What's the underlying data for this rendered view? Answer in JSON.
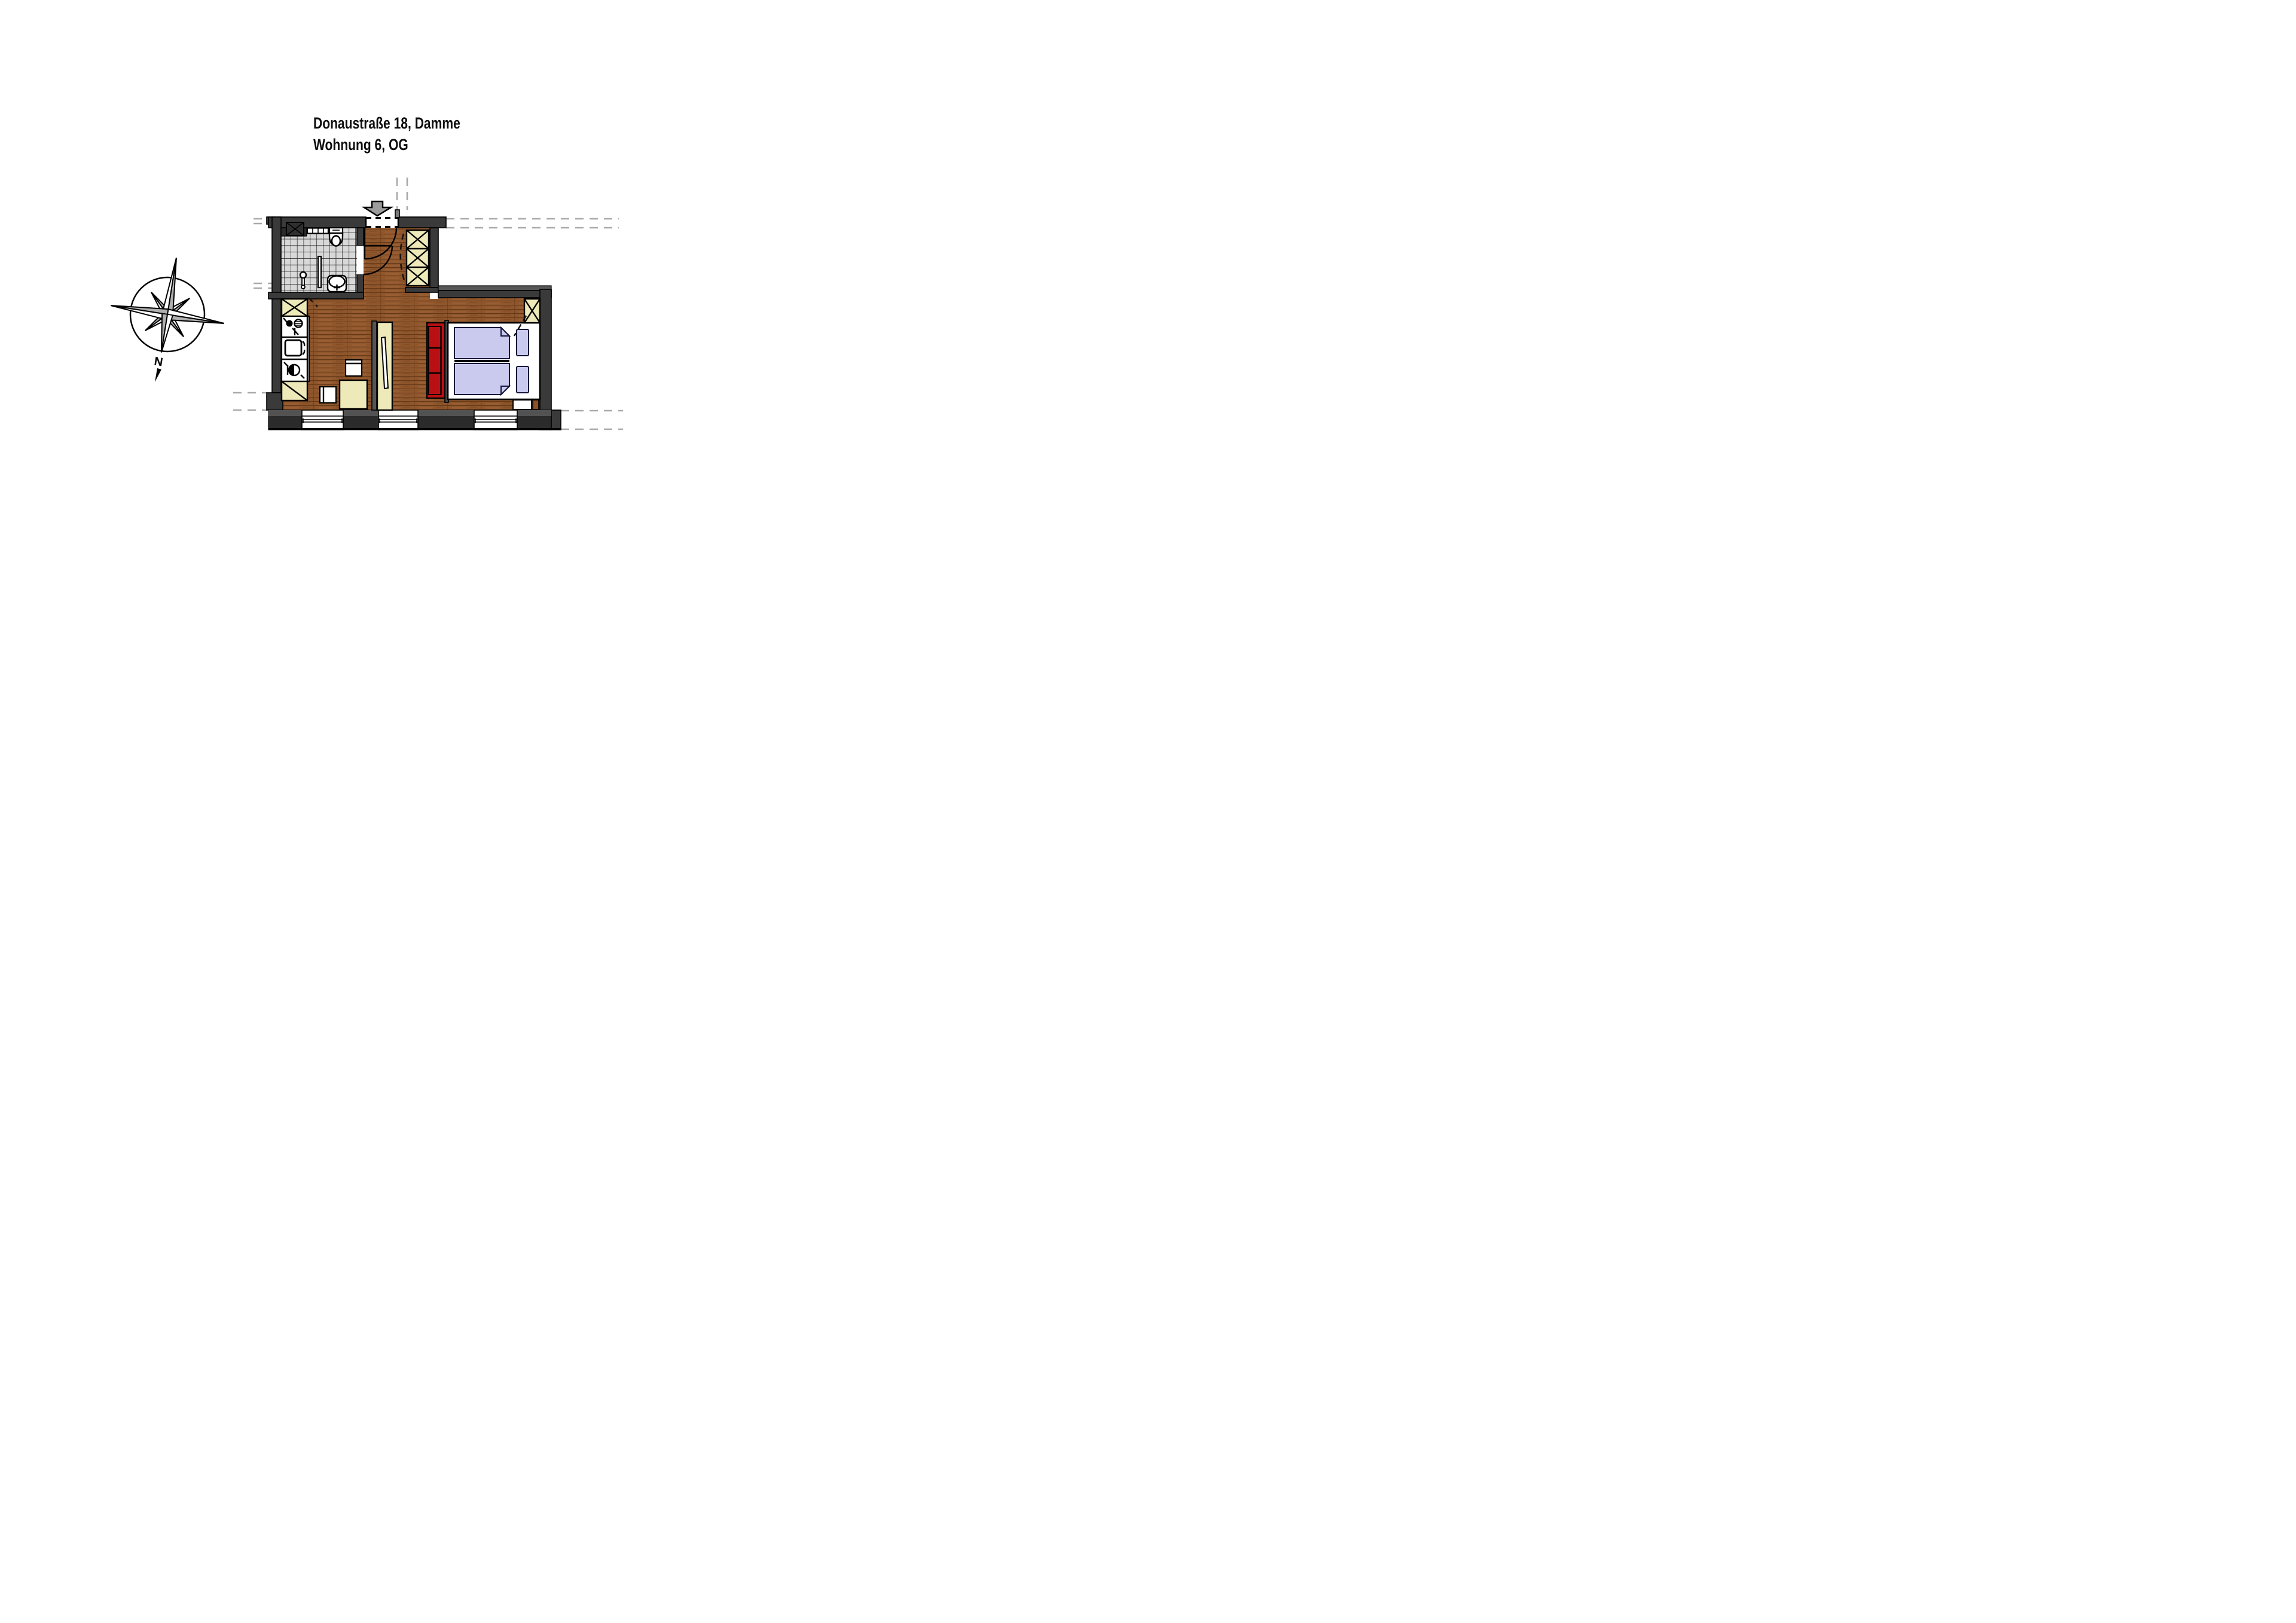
{
  "title": {
    "line1": "Donaustraße 18, Damme",
    "line2": "Wohnung 6, OG"
  },
  "compass": {
    "north_label": "N"
  },
  "colors": {
    "wall": "#3a3a3a",
    "wall_light": "#575757",
    "wood": "#8f562c",
    "wood_line": "#5e3414",
    "tile": "#d8d8d8",
    "grout": "#1f1f1f",
    "furniture_yellow": "#eee9b9",
    "sofa_red": "#b91113",
    "bedding_lavender": "#c9caee",
    "arrow_gray": "#9c9c9c",
    "dash_gray": "#a9a9a9"
  },
  "icons": [
    "compass-rose-icon",
    "north-arrow-icon",
    "entrance-arrow-icon",
    "shaft-icon",
    "towel-radiator-icon",
    "toilet-icon",
    "washbasin-icon",
    "shower-screen-icon",
    "wardrobe-icon",
    "tall-cabinet-icon",
    "cooktop-icon",
    "kitchen-sink-icon",
    "washing-machine-icon",
    "base-cabinet-icon",
    "dining-table-icon",
    "chair-icon",
    "room-divider-icon",
    "sofa-icon",
    "double-bed-icon",
    "pillow-icon",
    "nightstand-icon",
    "window-icon",
    "door-swing-icon"
  ]
}
